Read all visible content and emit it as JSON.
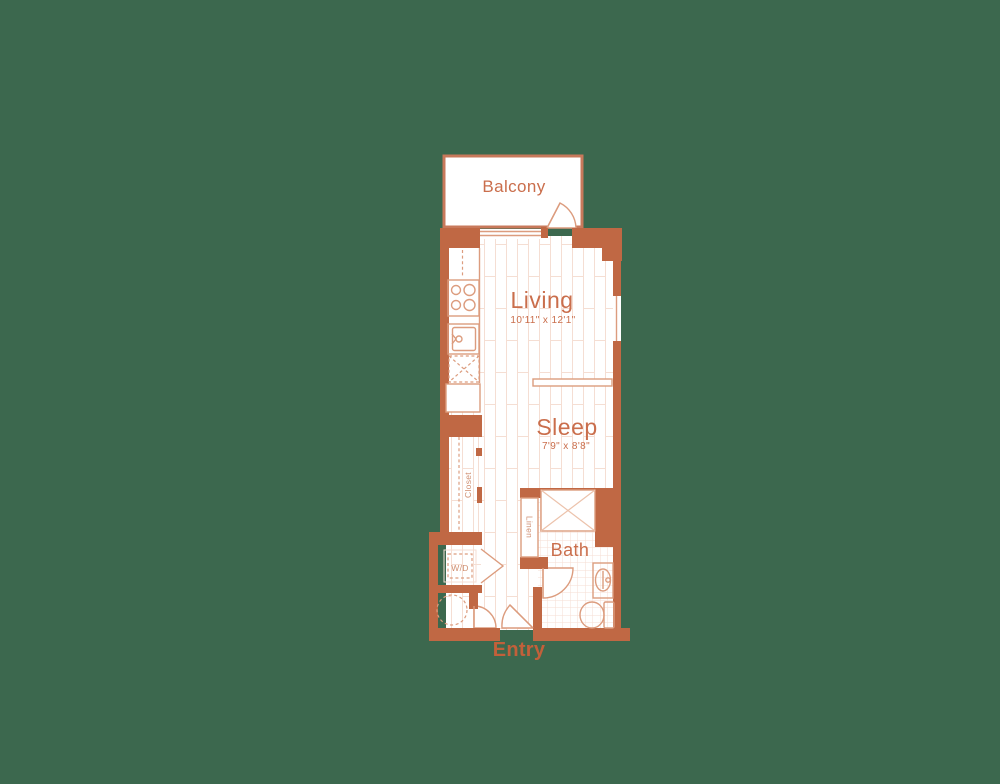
{
  "palette": {
    "background": "#3c684e",
    "wall": "#c06844",
    "wall_light": "#c8795b",
    "line": "#dc9c7e",
    "line_faint": "#f5ded3",
    "label": "#ca6e4c",
    "fixture_label": "#cf8e70",
    "entry_label": "#c2603a"
  },
  "floor_plan": {
    "balcony": {
      "label": "Balcony"
    },
    "living": {
      "label": "Living",
      "dimensions": "10'11\" x 12'1\""
    },
    "sleep": {
      "label": "Sleep",
      "dimensions": "7'9\" x 8'8\""
    },
    "bath": {
      "label": "Bath"
    },
    "closet": {
      "label": "Closet"
    },
    "linen": {
      "label": "Linen"
    },
    "washer_dryer": {
      "label": "W/D"
    },
    "entry": {
      "label": "Entry"
    }
  }
}
